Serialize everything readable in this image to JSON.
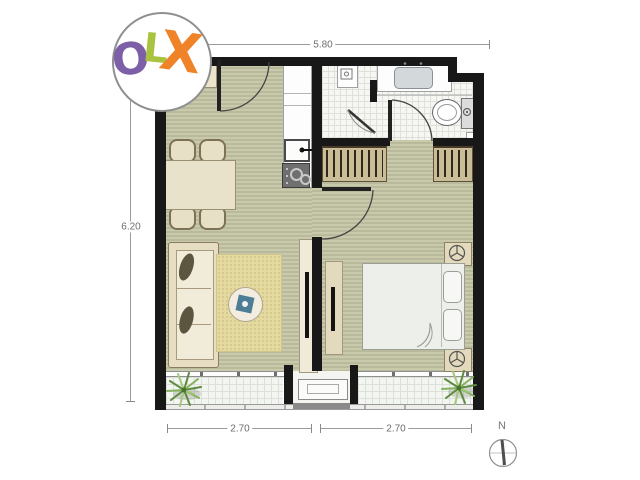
{
  "watermark": {
    "o": "O",
    "l": "L",
    "x": "X",
    "colors": {
      "o": "#7d5fa8",
      "l": "#a9c23f",
      "x": "#f08228",
      "circle_border": "#8f8f8f"
    }
  },
  "dimensions": {
    "top": "5.80",
    "left": "6.20",
    "bottom_left": "2.70",
    "bottom_right": "2.70"
  },
  "compass": {
    "north": "N"
  },
  "palette": {
    "wall": "#181818",
    "wood_floor": "#c3c3a5",
    "wardrobe": "#c9bd97",
    "rug": "#e3d9a1",
    "bathroom_tile": "#f6f7f3",
    "balcony_tile": "#f3f5f1",
    "coffee_table_accent": "#4e7d96",
    "plant": "#6f9d4e"
  }
}
